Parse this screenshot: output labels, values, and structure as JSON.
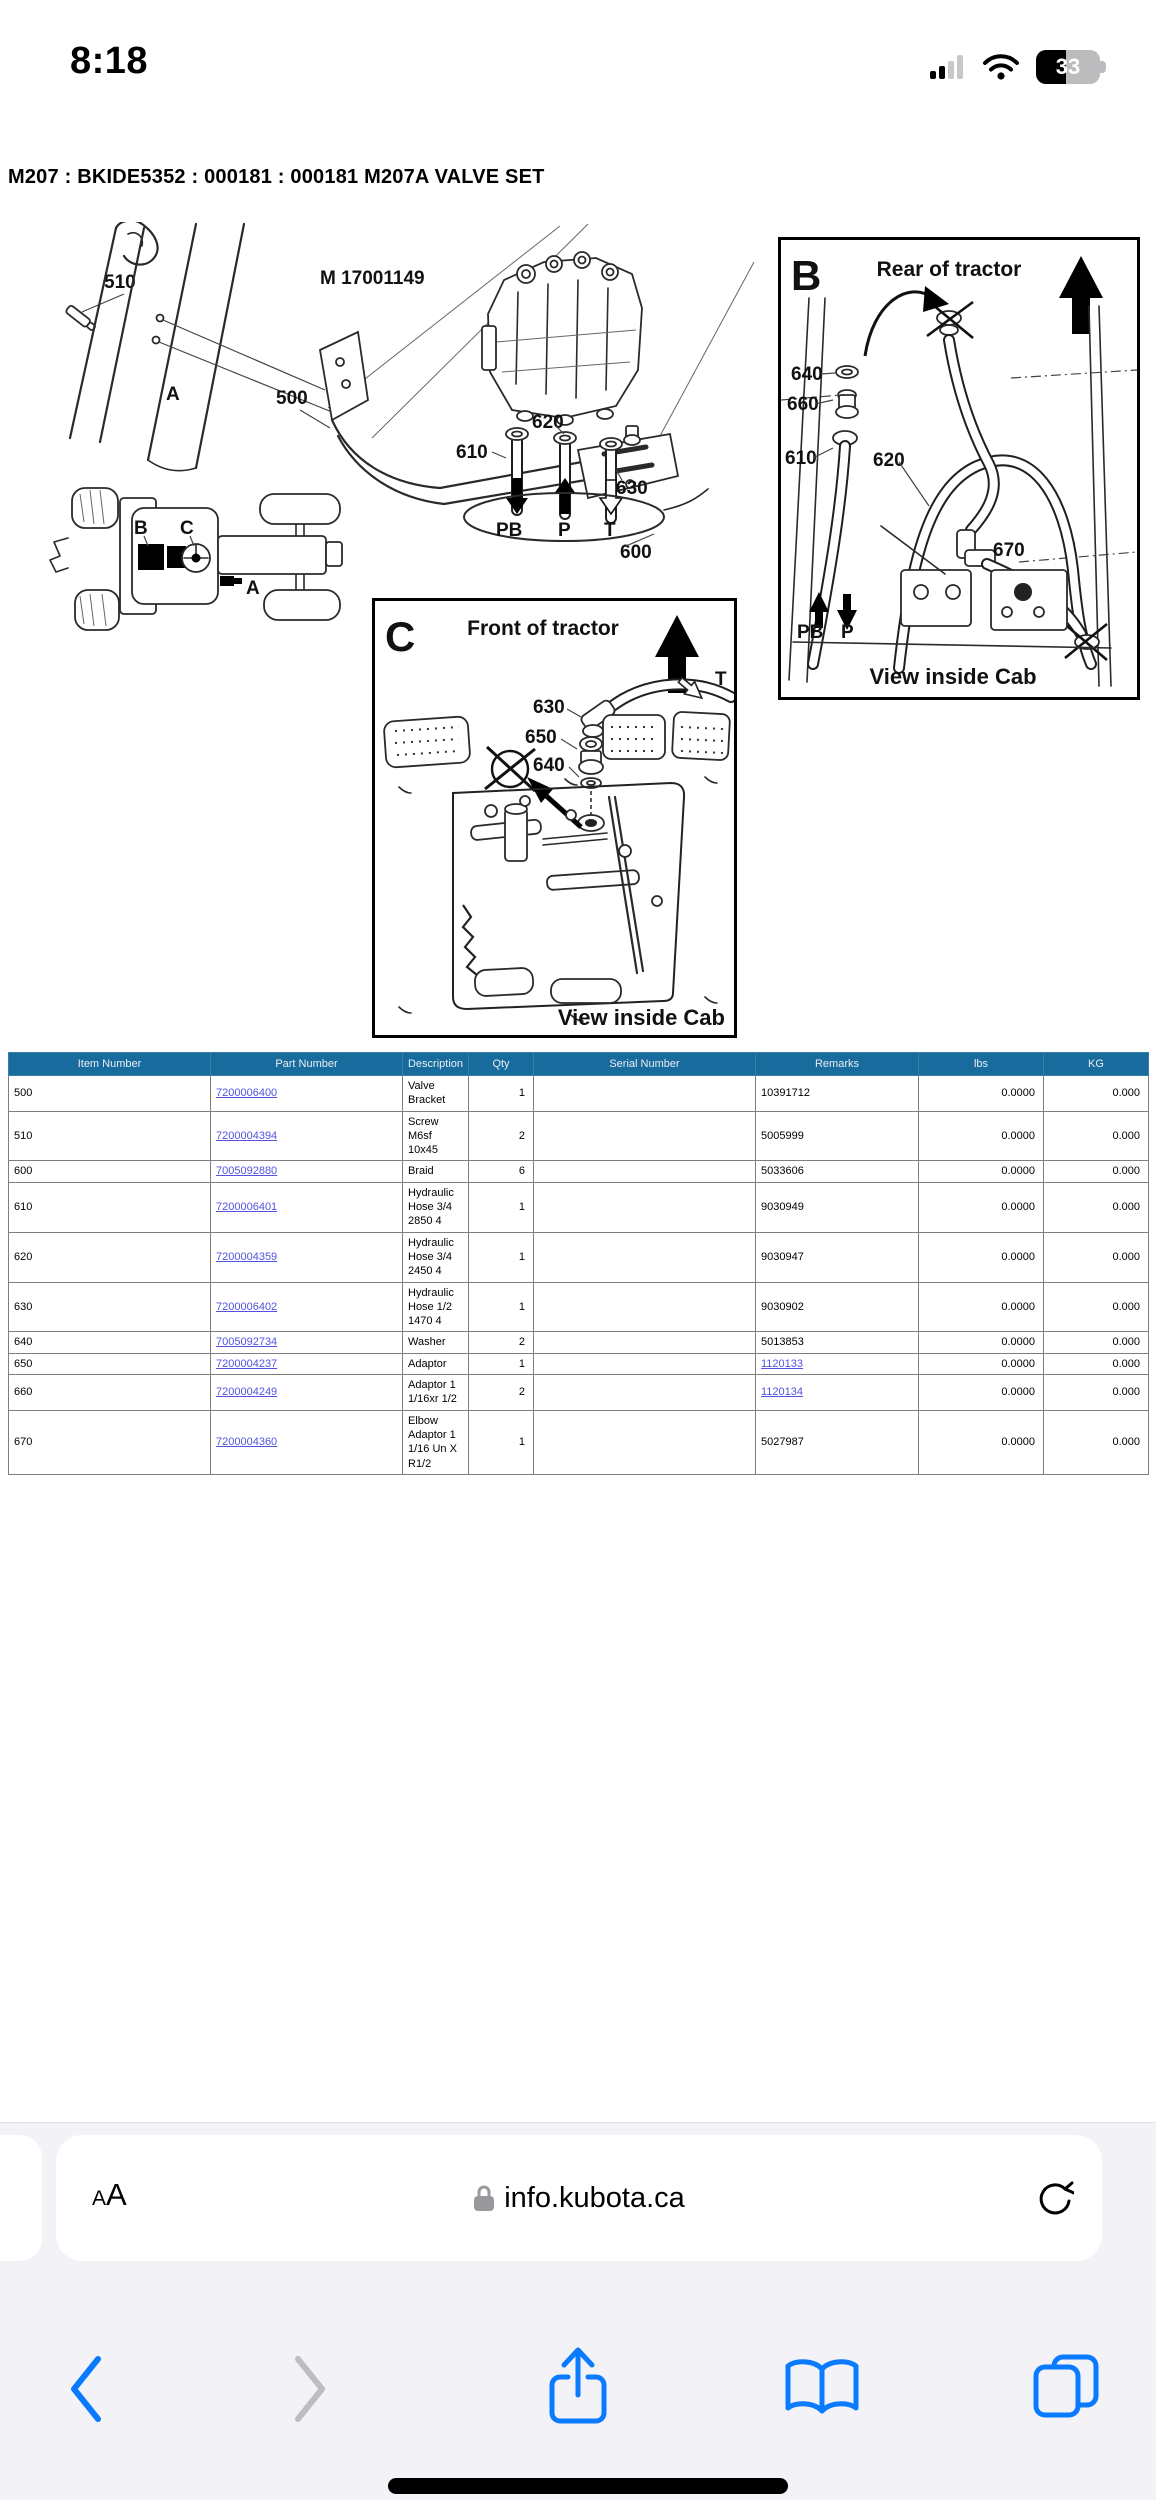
{
  "status_bar": {
    "time": "8:18",
    "battery_percent": "33"
  },
  "page_title": "M207 : BKIDE5352 : 000181 : 000181 M207A VALVE SET",
  "diagram": {
    "figure_code": "M 17001149",
    "section_a": {
      "letter": "A",
      "callout_510": "510",
      "callout_500": "500",
      "valve": {
        "callout_620": "620",
        "callout_610": "610",
        "callout_630": "630",
        "callout_600": "600",
        "port_pb": "PB",
        "port_p": "P",
        "port_t": "T"
      },
      "tractor": {
        "label_b": "B",
        "label_c": "C",
        "label_a": "A"
      }
    },
    "panel_b": {
      "letter": "B",
      "heading": "Rear of tractor",
      "footer": "View inside Cab",
      "callout_640": "640",
      "callout_660": "660",
      "callout_610": "610",
      "callout_620": "620",
      "callout_670": "670",
      "port_pb": "PB",
      "port_p": "P"
    },
    "panel_c": {
      "letter": "C",
      "heading": "Front of tractor",
      "footer": "View inside Cab",
      "callout_630": "630",
      "callout_650": "650",
      "callout_640": "640",
      "port_t": "T"
    }
  },
  "table": {
    "headers": [
      "Item Number",
      "Part Number",
      "Description",
      "Qty",
      "Serial Number",
      "Remarks",
      "lbs",
      "KG"
    ],
    "rows": [
      {
        "item": "500",
        "part": "7200006400",
        "desc": "Valve Bracket",
        "qty": "1",
        "serial": "",
        "remarks": "10391712",
        "lbs": "0.0000",
        "kg": "0.000"
      },
      {
        "item": "510",
        "part": "7200004394",
        "desc": "Screw M6sf 10x45",
        "qty": "2",
        "serial": "",
        "remarks": "5005999",
        "lbs": "0.0000",
        "kg": "0.000"
      },
      {
        "item": "600",
        "part": "7005092880",
        "desc": "Braid",
        "qty": "6",
        "serial": "",
        "remarks": "5033606",
        "lbs": "0.0000",
        "kg": "0.000"
      },
      {
        "item": "610",
        "part": "7200006401",
        "desc": "Hydraulic Hose 3/4 2850 4",
        "qty": "1",
        "serial": "",
        "remarks": "9030949",
        "lbs": "0.0000",
        "kg": "0.000"
      },
      {
        "item": "620",
        "part": "7200004359",
        "desc": "Hydraulic Hose 3/4 2450 4",
        "qty": "1",
        "serial": "",
        "remarks": "9030947",
        "lbs": "0.0000",
        "kg": "0.000"
      },
      {
        "item": "630",
        "part": "7200006402",
        "desc": "Hydraulic Hose 1/2 1470 4",
        "qty": "1",
        "serial": "",
        "remarks": "9030902",
        "lbs": "0.0000",
        "kg": "0.000"
      },
      {
        "item": "640",
        "part": "7005092734",
        "desc": "Washer",
        "qty": "2",
        "serial": "",
        "remarks": "5013853",
        "lbs": "0.0000",
        "kg": "0.000"
      },
      {
        "item": "650",
        "part": "7200004237",
        "desc": "Adaptor",
        "qty": "1",
        "serial": "",
        "remarks": "1120133",
        "lbs": "0.0000",
        "kg": "0.000"
      },
      {
        "item": "660",
        "part": "7200004249",
        "desc": "Adaptor 1 1/16xr 1/2",
        "qty": "2",
        "serial": "",
        "remarks": "1120134",
        "lbs": "0.0000",
        "kg": "0.000"
      },
      {
        "item": "670",
        "part": "7200004360",
        "desc": "Elbow Adaptor 1 1/16 Un X R1/2",
        "qty": "1",
        "serial": "",
        "remarks": "5027987",
        "lbs": "0.0000",
        "kg": "0.000"
      }
    ]
  },
  "browser": {
    "reader_small": "A",
    "reader_large": "A",
    "domain": "info.kubota.ca"
  },
  "colors": {
    "table_header_bg": "#186B9D",
    "link": "#5353DF",
    "ios_blue": "#0A7AFF"
  }
}
